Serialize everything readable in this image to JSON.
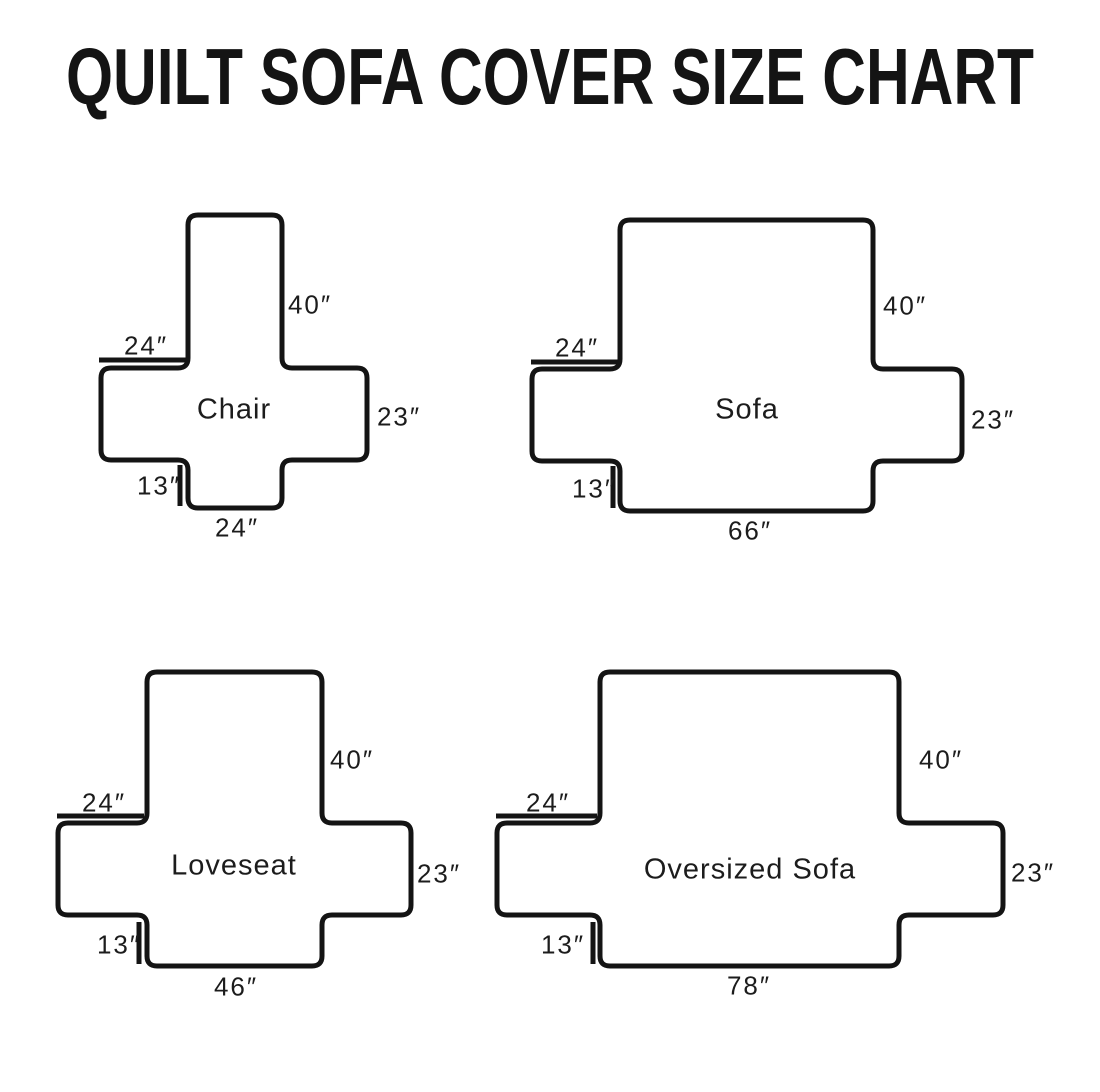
{
  "title": "QUILT SOFA COVER SIZE CHART",
  "colors": {
    "line": "#141414",
    "text": "#1c1c1c",
    "background": "#ffffff"
  },
  "diagrams": [
    {
      "name": "Chair",
      "labels": {
        "back_height": "40″",
        "arm_width": "24″",
        "side_drop": "23″",
        "front_skirt": "13″",
        "seat_width": "24″"
      }
    },
    {
      "name": "Sofa",
      "labels": {
        "back_height": "40″",
        "arm_width": "24″",
        "side_drop": "23″",
        "front_skirt": "13″",
        "seat_width": "66″"
      }
    },
    {
      "name": "Loveseat",
      "labels": {
        "back_height": "40″",
        "arm_width": "24″",
        "side_drop": "23″",
        "front_skirt": "13″",
        "seat_width": "46″"
      }
    },
    {
      "name": "Oversized Sofa",
      "labels": {
        "back_height": "40″",
        "arm_width": "24″",
        "side_drop": "23″",
        "front_skirt": "13″",
        "seat_width": "78″"
      }
    }
  ]
}
